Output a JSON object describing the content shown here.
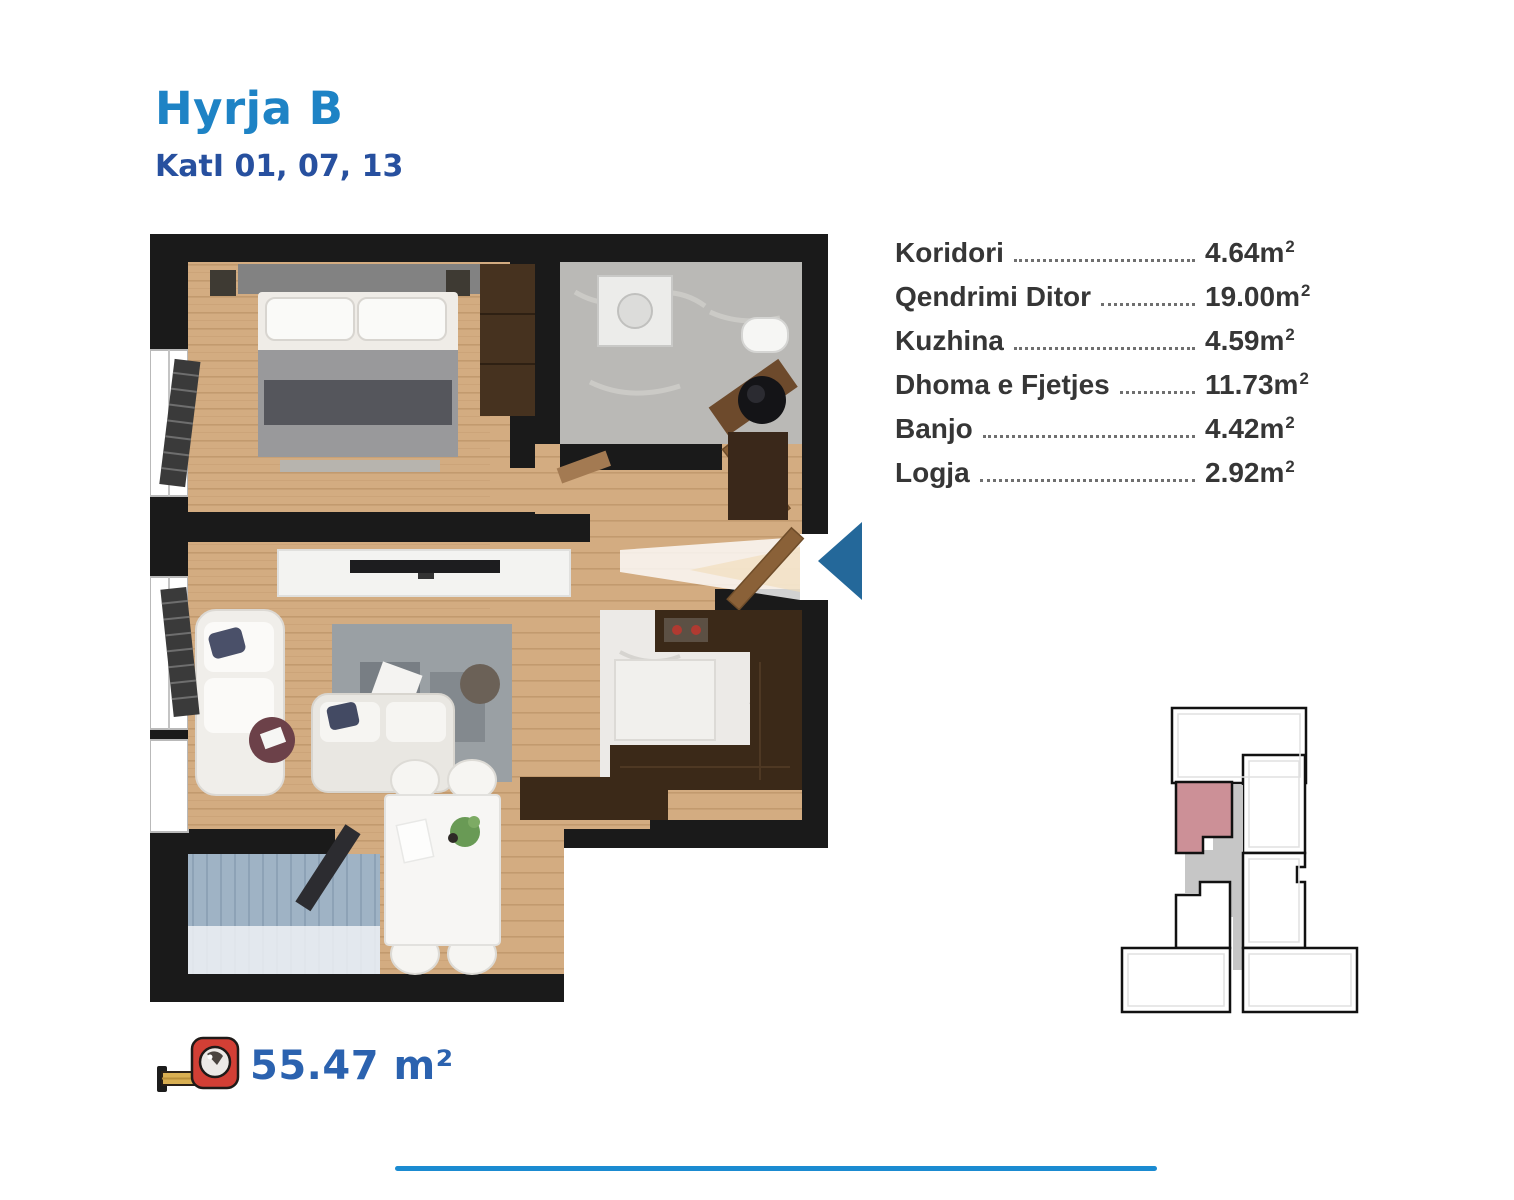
{
  "header": {
    "title": "Hyrja B",
    "subtitle": "KatI 01, 07, 13"
  },
  "rooms": [
    {
      "label": "Koridori",
      "value": "4.64"
    },
    {
      "label": "Qendrimi Ditor",
      "value": "19.00"
    },
    {
      "label": "Kuzhina",
      "value": "4.59"
    },
    {
      "label": "Dhoma e Fjetjes",
      "value": "11.73"
    },
    {
      "label": "Banjo",
      "value": "4.42"
    },
    {
      "label": "Logja",
      "value": "2.92"
    }
  ],
  "unit": {
    "symbol": "m",
    "exponent": "2"
  },
  "total": {
    "area_label": "55.47 m²"
  },
  "colors": {
    "title_blue": "#1e83c5",
    "subtitle_blue": "#27509f",
    "total_blue": "#2b62af",
    "divider_blue": "#1b8bd1",
    "arrow_blue": "#24689a",
    "minimap_highlight": "#cc9097",
    "minimap_core_gray": "#c6c6c6"
  }
}
